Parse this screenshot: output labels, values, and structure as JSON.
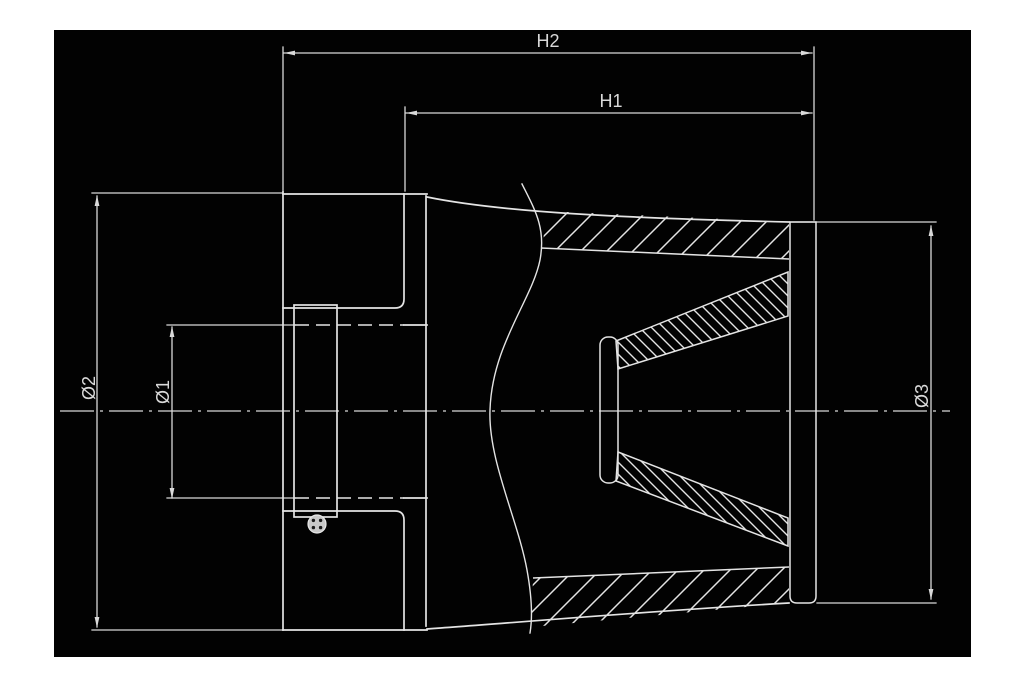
{
  "drawing": {
    "page_background": "#ffffff",
    "canvas_background": "#020202",
    "line_color": "#e4e4e4",
    "dim_color": "#d9d9d9",
    "labels": {
      "h2": "H2",
      "h1": "H1",
      "diameter1": "Ø1",
      "diameter2": "Ø2",
      "diameter3": "Ø3"
    }
  }
}
